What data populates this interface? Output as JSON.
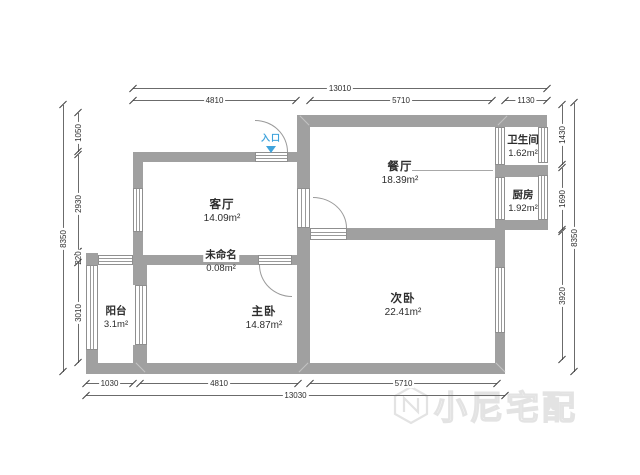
{
  "rooms": [
    {
      "name": "客厅",
      "area": "14.09m²"
    },
    {
      "name": "餐厅",
      "area": "18.39m²"
    },
    {
      "name": "卫生间",
      "area": "1.62m²"
    },
    {
      "name": "厨房",
      "area": "1.92m²"
    },
    {
      "name": "次卧",
      "area": "22.41m²"
    },
    {
      "name": "主卧",
      "area": "14.87m²"
    },
    {
      "name": "阳台",
      "area": "3.1m²"
    },
    {
      "name": "未命名",
      "area": "0.08m²"
    }
  ],
  "entrance": {
    "label": "入口",
    "color": "#3fa3dc"
  },
  "dimensions": {
    "top_total": "13010",
    "top_segments": [
      "4810",
      "5710",
      "1130"
    ],
    "bottom_segments": [
      "1030",
      "4810",
      "5710"
    ],
    "bottom_total": "13030",
    "left_outer": "8350",
    "left_segments": [
      "1050",
      "2930",
      "220",
      "3010"
    ],
    "right_outer": "8350",
    "right_segments": [
      "1430",
      "1690",
      "3920"
    ]
  },
  "watermark": {
    "text": "小尼宅配"
  },
  "colors": {
    "wall": "#a0a0a0",
    "dim_line": "#6b6b6b",
    "entrance_blue": "#3fa3dc"
  }
}
